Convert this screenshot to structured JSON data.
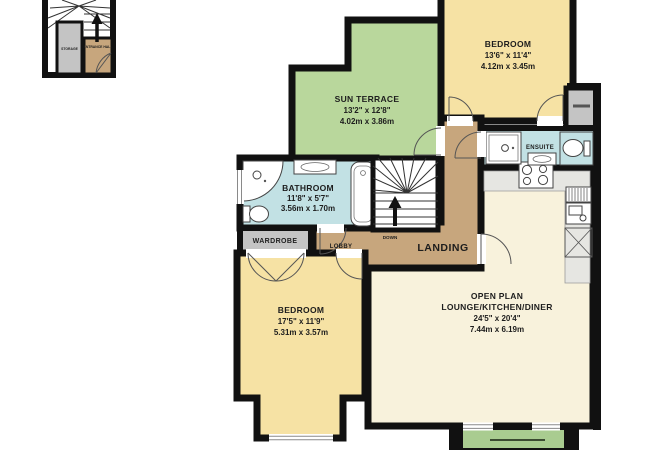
{
  "plan": {
    "type": "floorplan",
    "colors": {
      "wall": "#111111",
      "bedroom_yellow": "#f6e2a4",
      "terrace_green": "#b9d79c",
      "balcony_green": "#a9cc90",
      "lounge_cream": "#f8f2dc",
      "hall_tan": "#c7a67d",
      "bath_blue": "#c2e1e4",
      "storage_gray": "#c4c4c4",
      "counter_gray": "#e6e6e2"
    },
    "inset": {
      "storage_label": "STORAGE",
      "entrance_label": "ENTRANCE HALL"
    },
    "rooms": {
      "bedroom_top_right": {
        "name": "BEDROOM",
        "imperial": "13'6\" x 11'4\"",
        "metric": "4.12m x 3.45m"
      },
      "sun_terrace": {
        "name": "SUN TERRACE",
        "imperial": "13'2\" x 12'8\"",
        "metric": "4.02m x 3.86m"
      },
      "bathroom": {
        "name": "BATHROOM",
        "imperial": "11'8\" x 5'7\"",
        "metric": "3.56m x 1.70m"
      },
      "wardrobe": {
        "name": "WARDROBE"
      },
      "lobby": {
        "name": "LOBBY"
      },
      "landing": {
        "name": "LANDING"
      },
      "stairs": {
        "direction_label": "DOWN"
      },
      "ensuite": {
        "name": "ENSUITE"
      },
      "open_plan": {
        "line1": "OPEN PLAN",
        "line2": "LOUNGE/KITCHEN/DINER",
        "imperial": "24'5\" x 20'4\"",
        "metric": "7.44m x 6.19m"
      },
      "bedroom_bottom_left": {
        "name": "BEDROOM",
        "imperial": "17'5\" x 11'9\"",
        "metric": "5.31m x 3.57m"
      }
    }
  }
}
